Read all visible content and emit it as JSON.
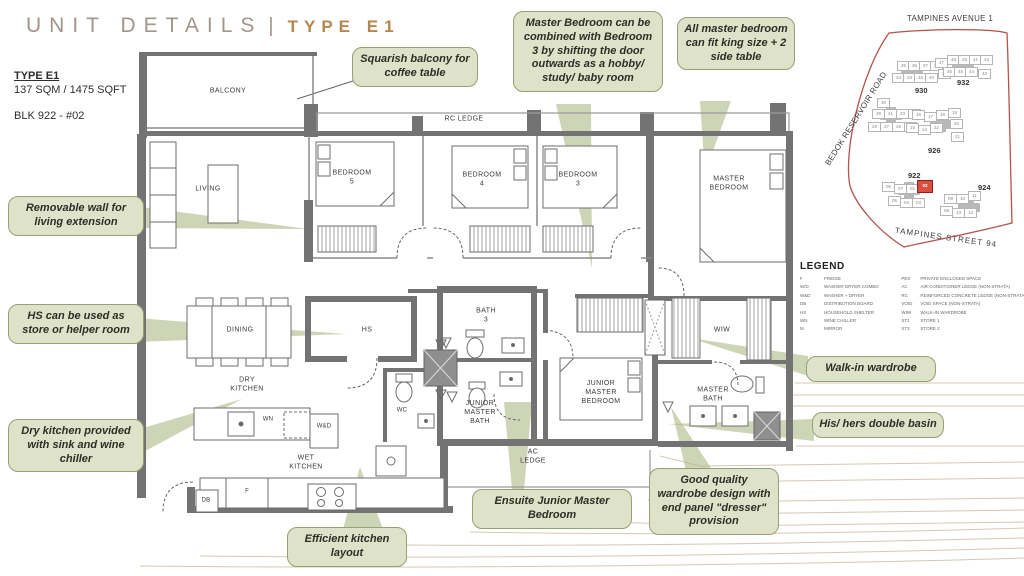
{
  "title": {
    "main": "UNIT DETAILS",
    "separator": "|",
    "type": "TYPE E1"
  },
  "unit_info": {
    "type_label": "TYPE E1",
    "area": "137 SQM / 1475 SQFT",
    "block": "BLK 922 - #02"
  },
  "floorplan": {
    "rooms": [
      {
        "name": "balcony",
        "label": "BALCONY"
      },
      {
        "name": "rc-ledge",
        "label": "RC LEDGE"
      },
      {
        "name": "living",
        "label": "LIVING"
      },
      {
        "name": "bedroom-5",
        "label": "BEDROOM\n5"
      },
      {
        "name": "bedroom-4",
        "label": "BEDROOM\n4"
      },
      {
        "name": "bedroom-3",
        "label": "BEDROOM\n3"
      },
      {
        "name": "master-bedroom",
        "label": "MASTER\nBEDROOM"
      },
      {
        "name": "dining",
        "label": "DINING"
      },
      {
        "name": "hs",
        "label": "HS"
      },
      {
        "name": "bath-3",
        "label": "BATH\n3"
      },
      {
        "name": "wiw",
        "label": "WIW"
      },
      {
        "name": "dry-kitchen",
        "label": "DRY\nKITCHEN"
      },
      {
        "name": "wc",
        "label": "WC"
      },
      {
        "name": "junior-master-bath",
        "label": "JUNIOR\nMASTER\nBATH"
      },
      {
        "name": "junior-master-bedroom",
        "label": "JUNIOR\nMASTER\nBEDROOM"
      },
      {
        "name": "master-bath",
        "label": "MASTER\nBATH"
      },
      {
        "name": "wd-box",
        "label": "W&D"
      },
      {
        "name": "wn-box",
        "label": "WN"
      },
      {
        "name": "wet-kitchen",
        "label": "WET\nKITCHEN"
      },
      {
        "name": "ac-ledge",
        "label": "AC\nLEDGE"
      },
      {
        "name": "db-box",
        "label": "DB"
      },
      {
        "name": "fridge-box",
        "label": "F"
      }
    ]
  },
  "callouts": [
    {
      "name": "squarish-balcony",
      "text": "Squarish balcony for coffee table"
    },
    {
      "name": "master-combine",
      "text": "Master Bedroom can be combined with Bedroom 3 by shifting the door outwards as a hobby/ study/ baby room"
    },
    {
      "name": "king-size",
      "text": "All master bedroom can fit king size + 2 side table"
    },
    {
      "name": "removable-wall",
      "text": "Removable wall for living extension"
    },
    {
      "name": "hs-store",
      "text": "HS can be used as store or helper room"
    },
    {
      "name": "dry-kitchen",
      "text": "Dry kitchen provided with sink and wine chiller"
    },
    {
      "name": "walk-in-wardrobe",
      "text": "Walk-in wardrobe"
    },
    {
      "name": "his-hers-basin",
      "text": "His/ hers double basin"
    },
    {
      "name": "ensuite-junior",
      "text": "Ensuite Junior Master Bedroom"
    },
    {
      "name": "wardrobe-dresser",
      "text": "Good quality wardrobe design with end panel \"dresser\" provision"
    },
    {
      "name": "efficient-kitchen",
      "text": "Efficient kitchen layout"
    }
  ],
  "map": {
    "roads": {
      "top": "TAMPINES AVENUE 1",
      "left": "BEDOK RESERVOIR ROAD",
      "bottom": "TAMPINES STREET 94"
    },
    "highlighted_unit": "02",
    "blocks": [
      {
        "label": "930",
        "label_x": 915,
        "label_y": 86,
        "blob_x": 901,
        "blob_y": 68,
        "units": [
          {
            "t": "35",
            "x": 897,
            "y": 61
          },
          {
            "t": "36",
            "x": 908,
            "y": 61
          },
          {
            "t": "37",
            "x": 919,
            "y": 61
          },
          {
            "t": "38",
            "x": 930,
            "y": 61
          },
          {
            "t": "34",
            "x": 892,
            "y": 73
          },
          {
            "t": "33",
            "x": 903,
            "y": 73
          },
          {
            "t": "32",
            "x": 914,
            "y": 73
          },
          {
            "t": "40",
            "x": 925,
            "y": 73
          },
          {
            "t": "39",
            "x": 938,
            "y": 69
          }
        ]
      },
      {
        "label": "932",
        "label_x": 957,
        "label_y": 78,
        "blob_x": 952,
        "blob_y": 60,
        "units": [
          {
            "t": "47",
            "x": 935,
            "y": 58
          },
          {
            "t": "48",
            "x": 947,
            "y": 55
          },
          {
            "t": "49",
            "x": 958,
            "y": 55
          },
          {
            "t": "41",
            "x": 969,
            "y": 55
          },
          {
            "t": "42",
            "x": 980,
            "y": 55
          },
          {
            "t": "46",
            "x": 943,
            "y": 67
          },
          {
            "t": "45",
            "x": 954,
            "y": 67
          },
          {
            "t": "44",
            "x": 965,
            "y": 67
          },
          {
            "t": "43",
            "x": 978,
            "y": 69
          }
        ]
      },
      {
        "label": "928",
        "label_x": 882,
        "label_y": 122,
        "blob_x": 880,
        "blob_y": 111,
        "units": [
          {
            "t": "30",
            "x": 877,
            "y": 98
          },
          {
            "t": "29",
            "x": 872,
            "y": 109
          },
          {
            "t": "31",
            "x": 884,
            "y": 109
          },
          {
            "t": "23",
            "x": 896,
            "y": 109
          },
          {
            "t": "24",
            "x": 908,
            "y": 109
          },
          {
            "t": "28",
            "x": 868,
            "y": 122
          },
          {
            "t": "27",
            "x": 880,
            "y": 122
          },
          {
            "t": "26",
            "x": 892,
            "y": 122
          },
          {
            "t": "25",
            "x": 904,
            "y": 122
          }
        ]
      },
      {
        "label": "926",
        "label_x": 928,
        "label_y": 146,
        "blob_x": 930,
        "blob_y": 120,
        "units": [
          {
            "t": "16",
            "x": 912,
            "y": 110
          },
          {
            "t": "17",
            "x": 924,
            "y": 112
          },
          {
            "t": "18",
            "x": 936,
            "y": 110
          },
          {
            "t": "19",
            "x": 948,
            "y": 108
          },
          {
            "t": "15",
            "x": 906,
            "y": 123
          },
          {
            "t": "14",
            "x": 918,
            "y": 125
          },
          {
            "t": "22",
            "x": 930,
            "y": 123
          },
          {
            "t": "20",
            "x": 950,
            "y": 119
          },
          {
            "t": "21",
            "x": 951,
            "y": 132
          }
        ]
      },
      {
        "label": "922",
        "label_x": 908,
        "label_y": 171,
        "blob_x": 898,
        "blob_y": 186,
        "units": [
          {
            "t": "06",
            "x": 882,
            "y": 182
          },
          {
            "t": "07",
            "x": 894,
            "y": 184
          },
          {
            "t": "01",
            "x": 906,
            "y": 184
          },
          {
            "t": "02",
            "x": 917,
            "y": 180,
            "hl": true
          },
          {
            "t": "05",
            "x": 888,
            "y": 196
          },
          {
            "t": "04",
            "x": 900,
            "y": 198
          },
          {
            "t": "03",
            "x": 912,
            "y": 198
          }
        ]
      },
      {
        "label": "924",
        "label_x": 978,
        "label_y": 183,
        "blob_x": 958,
        "blob_y": 203,
        "units": [
          {
            "t": "09",
            "x": 944,
            "y": 194
          },
          {
            "t": "10",
            "x": 956,
            "y": 194
          },
          {
            "t": "11",
            "x": 968,
            "y": 191
          },
          {
            "t": "08",
            "x": 940,
            "y": 206
          },
          {
            "t": "13",
            "x": 952,
            "y": 208
          },
          {
            "t": "12",
            "x": 964,
            "y": 208
          }
        ]
      }
    ]
  },
  "legend": {
    "heading": "LEGEND",
    "left": [
      {
        "abbr": "F",
        "label": "FRIDGE"
      },
      {
        "abbr": "W/D",
        "label": "WASHER DRYER COMBO"
      },
      {
        "abbr": "W&D",
        "label": "WASHER + DRYER"
      },
      {
        "abbr": "DB",
        "label": "DISTRIBUTION BOARD"
      },
      {
        "abbr": "HS",
        "label": "HOUSEHOLD SHELTER"
      },
      {
        "abbr": "WN",
        "label": "WINE CHILLER"
      },
      {
        "abbr": "M",
        "label": "MIRROR"
      }
    ],
    "right": [
      {
        "abbr": "PES",
        "label": "PRIVATE ENCLOSED SPACE"
      },
      {
        "abbr": "AC",
        "label": "AIR CONDITIONER LEDGE (NON-STRATA)"
      },
      {
        "abbr": "RC",
        "label": "REINFORCED CONCRETE LEDGE (NON-STRATA)"
      },
      {
        "abbr": "VOID",
        "label": "VOID SPACE (NON-STRATA)"
      },
      {
        "abbr": "WIW",
        "label": "WALK-IN WARDROBE"
      },
      {
        "abbr": "ST1",
        "label": "STORE 1"
      },
      {
        "abbr": "ST2",
        "label": "STORE 2"
      }
    ]
  },
  "colors": {
    "accent_gold": "#b5874e",
    "title_taupe": "#a4948a",
    "callout_bg": "#dde2c9",
    "callout_border": "#93a175",
    "wall_gray": "#737373",
    "highlight_red": "#d94f43",
    "map_outline": "#b0544c",
    "contour_tan": "#d6c8b3"
  }
}
